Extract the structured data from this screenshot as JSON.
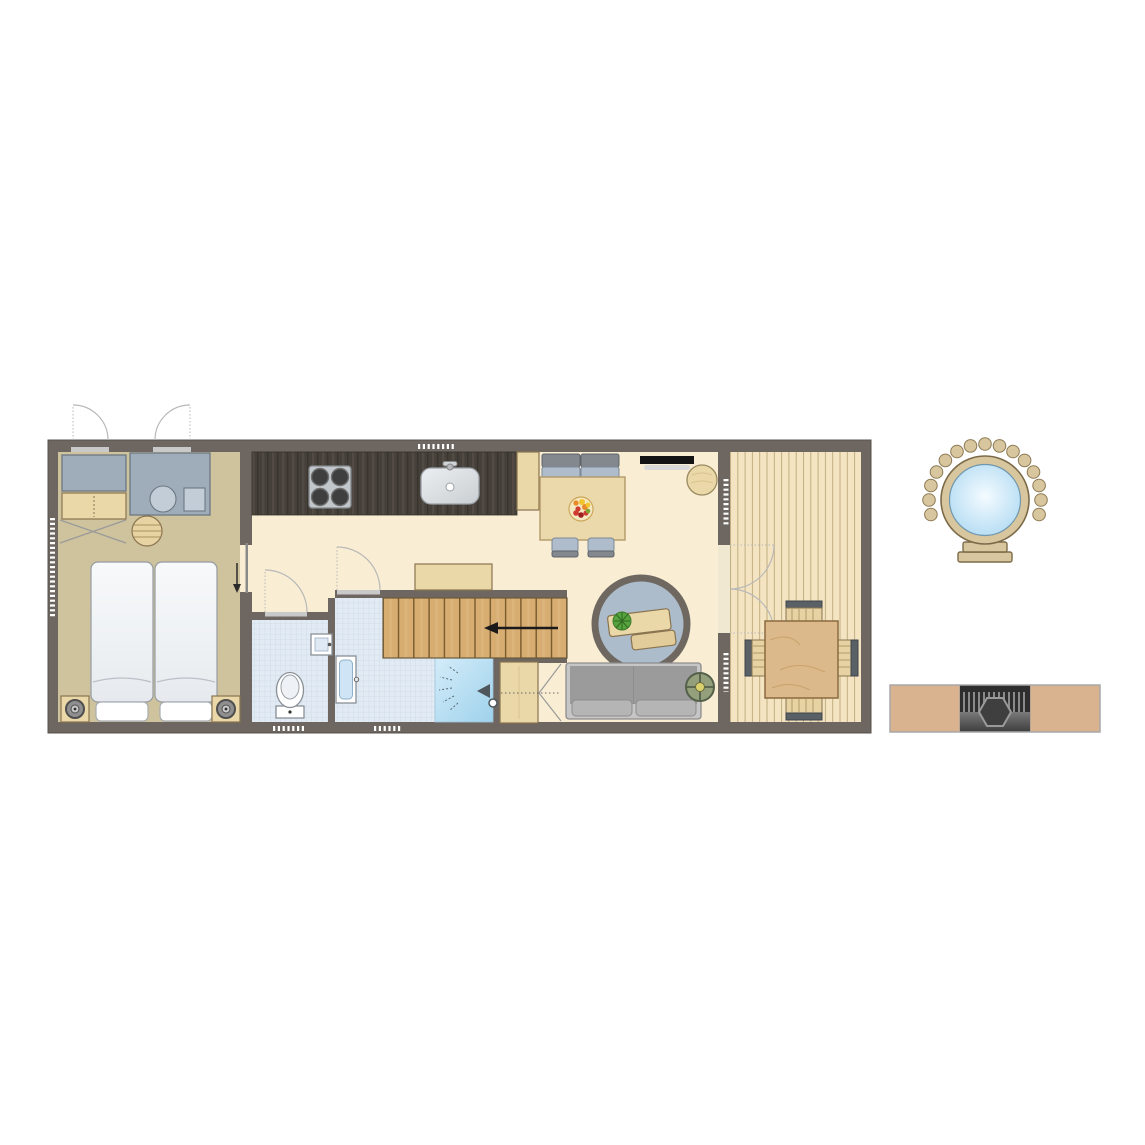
{
  "scene": {
    "type": "floor plan",
    "description": "Top-down architectural floor plan of a narrow holiday lodge: bedroom on the left, toilet and shower rooms with a staircase in the middle, open kitchen with dining and living area, and a covered deck with table and chairs on the right. A round hot tub with bead fence and entry steps and a barbecue table with integrated grill are drawn separately at the far right."
  },
  "colors": {
    "wall": "#6e6761",
    "main_floor": "#f9eed3",
    "bedroom_floor": "#cfc39d",
    "deck_floor": "#f4e4c2",
    "deck_line": "#c1ae80",
    "tile": "#e2ebf4",
    "tile_line": "#cbd9e7",
    "counter": "#46403a",
    "counter_streak": "#524b43",
    "wood_light": "#ead8a8",
    "wood_border": "#8a7450",
    "stairs": "#d8ad72",
    "stairs_line": "#77592c",
    "shower": "#b9ddf1",
    "gray_unit": "#9fadba",
    "gray_unit_border": "#6d7882",
    "sofa": "#9b9b9b",
    "rug": "#acbcca",
    "water": "#bfe3f7",
    "rim": "#d8c69e",
    "bbq_tan": "#d9b28f",
    "plant_green": "#57a33e"
  },
  "rooms": [
    {
      "name": "Bedroom"
    },
    {
      "name": "Hallway"
    },
    {
      "name": "Toilet"
    },
    {
      "name": "Shower room"
    },
    {
      "name": "Kitchen"
    },
    {
      "name": "Living / dining"
    },
    {
      "name": "Staircase"
    },
    {
      "name": "Deck"
    }
  ],
  "furniture": {
    "bedroom": [
      "double bed with two mattresses",
      "two pillows",
      "left nightstand with lamp",
      "right nightstand with lamp",
      "wardrobe",
      "dresser",
      "vanity unit with round washbasin",
      "stool"
    ],
    "kitchen": [
      "dark worktop",
      "4-burner hob",
      "sink with faucet",
      "tall cabinet"
    ],
    "dining": [
      "wooden table with fruit bowl",
      "bench with two cushions",
      "two chairs",
      "wall-mounted TV",
      "round pouf"
    ],
    "living": [
      "round rug",
      "two-piece coffee table",
      "plant",
      "two-seat sofa",
      "round side table"
    ],
    "bathroom": [
      "toilet",
      "mirror cabinet",
      "wall washbasin",
      "shower with hand shower",
      "storage cabinet"
    ],
    "stairs": [
      "staircase with direction arrow",
      "sideboard"
    ],
    "deck": [
      "square dining table",
      "four slatted chairs",
      "double doors to deck"
    ],
    "outdoor": [
      "round hot tub with bead fence and steps",
      "barbecue table with integrated grill"
    ]
  },
  "hot_tub": {
    "bead_count": 15,
    "steps": 3
  },
  "bbq": {
    "slat_count": 13
  }
}
